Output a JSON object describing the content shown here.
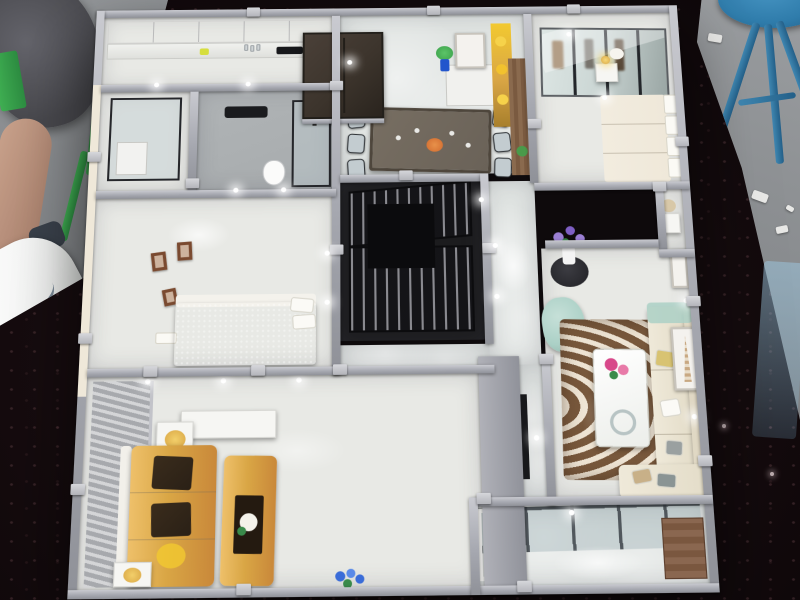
{
  "scene": {
    "type": "photograph",
    "subject": "miniature architectural scale model of a furnished apartment, viewed from above on a dark sparkly exhibition table",
    "surroundings": [
      "visitor leg with white sneaker",
      "green chair",
      "gray bag",
      "blue stool",
      "gray venue floor",
      "translucent blue sheet"
    ]
  },
  "colors": {
    "table": "#140b0e",
    "floorGray": "#8b8e91",
    "wall": "#a6a8b0",
    "wallLight": "#c9cad0",
    "wallDark": "#8f9198",
    "cream": "#efe8d9",
    "roomFloor": "#e8e9e5",
    "marble": "#dfe3e1",
    "kitchenCab": "#f4f4f2",
    "doorWood": "#3c342c",
    "bathFloor": "#a7abad",
    "black": "#1a1b1e",
    "blueBed": "#2f6fa8",
    "framesBrown": "#7a4a30",
    "studyDark": "#1c1c1e",
    "dinTable": "#6a6258",
    "chair": "#c3ccd0",
    "gold": "#d9a645",
    "goldDeep": "#c9883a",
    "goldBright": "#f2c930",
    "wood": "#8a6a4e",
    "mirror": "#ccd7d5",
    "teal": "#abd0c6",
    "purple": "#9b7fd4",
    "pink": "#d8488a",
    "rugBrown": "#8a6a4e",
    "rugCream": "#f0e8d8",
    "sofaCream": "#efe9d9",
    "cushionDark": "#2a2016",
    "stool": "#2f7cab",
    "green": "#3faf52",
    "skin": "#c9a28c",
    "sneaker": "#f2f3f2",
    "bluePanel": "#9cc4dc",
    "plantBlue": "#3a6cd8",
    "leafGreen": "#3a8a4a",
    "tvDark": "#17181b"
  },
  "rooms": [
    {
      "id": "kitchen",
      "contents": [
        "white upper cabinets",
        "counter with bottles",
        "dark cooktop"
      ]
    },
    {
      "id": "utility-room",
      "contents": [
        "glass partition",
        "white appliance"
      ]
    },
    {
      "id": "bathroom",
      "contents": [
        "black towel rack",
        "white toilet",
        "glass shower enclosure"
      ]
    },
    {
      "id": "bedroom-blue",
      "contents": [
        "blue sparkly bed",
        "white pillows",
        "three brown wall frames",
        "white shelf"
      ]
    },
    {
      "id": "dining-room",
      "contents": [
        "dark wood entry door",
        "dining table with glasses and orange centerpiece",
        "six gray chairs",
        "white cube sideboard",
        "art frame",
        "plant in blue vase",
        "gold display shelf",
        "wood partition"
      ]
    },
    {
      "id": "study",
      "contents": [
        "black lattice screens",
        "dark floor"
      ]
    },
    {
      "id": "bedroom-master",
      "contents": [
        "mirrored wardrobe with clothes",
        "cream bed with white headboard panels",
        "nightstand with gold lamp",
        "white flowers"
      ]
    },
    {
      "id": "hallway",
      "contents": [
        "polished marble floor",
        "LED downlights"
      ]
    },
    {
      "id": "living-room",
      "contents": [
        "purple flowers on black side table",
        "teal armchair",
        "brown wave-stripe rug",
        "white marble coffee table with pink flowers and glass bowl",
        "cream L-shaped sofa with yellow and gray pillows",
        "Eiffel tower art frame",
        "LED wall strips",
        "TV wall"
      ]
    },
    {
      "id": "gold-lounge",
      "contents": [
        "gray slat accent wall",
        "gold sofa with dark brown cushions",
        "gold bench table with dark tray and white flowers",
        "white side tables with gold decor"
      ]
    },
    {
      "id": "balcony",
      "contents": [
        "glass window grid",
        "white door frame",
        "wooden cabinet",
        "blue potted flowers"
      ]
    }
  ]
}
